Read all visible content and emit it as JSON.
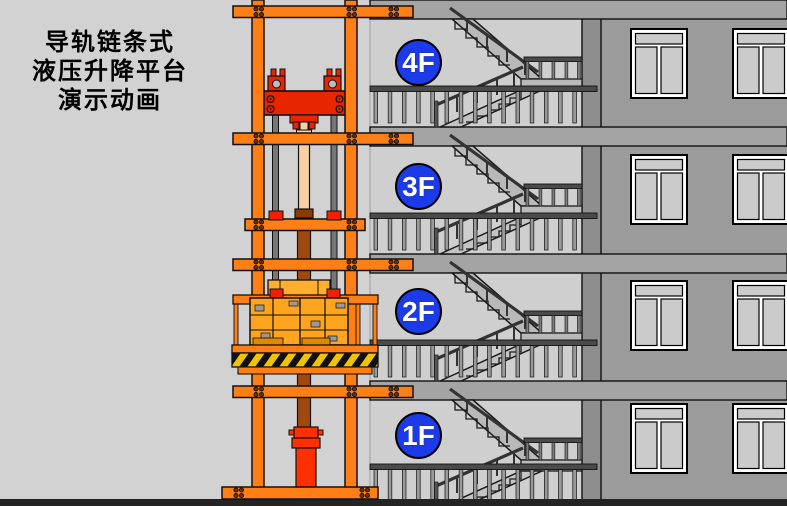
{
  "title": {
    "lines": [
      "导轨链条式",
      "液压升降平台",
      "演示动画"
    ]
  },
  "floors": [
    {
      "label": "4F"
    },
    {
      "label": "3F"
    },
    {
      "label": "2F"
    },
    {
      "label": "1F"
    }
  ],
  "colors": {
    "background": "#d2d2d2",
    "lift_orange": "#ff7f17",
    "head_beam_red": "#e92500",
    "cylinder_red": "#ff3000",
    "cylinder_rod_tan": "#f8d0a2",
    "cylinder_body_brown": "#a04a10",
    "floor_badge_blue": "#1c3be8",
    "hazard_yellow": "#f0c400",
    "facade_gray": "#9b9b9b",
    "stairwell_gray": "#cfcfcf",
    "ground_dark": "#242424"
  }
}
